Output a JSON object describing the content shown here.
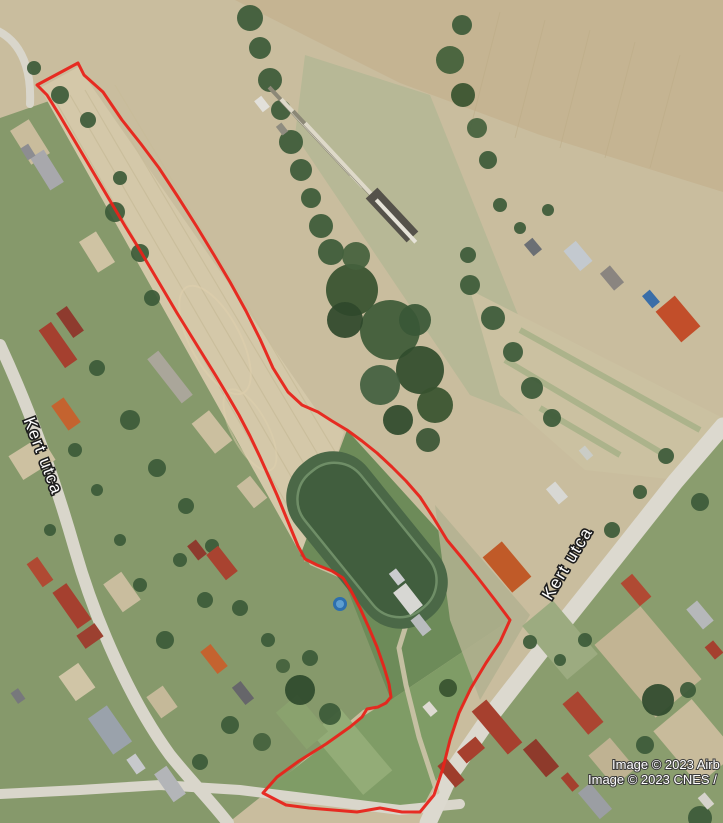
{
  "map": {
    "type": "satellite-imagery",
    "streets": [
      {
        "name": "Kert utca",
        "position": "west"
      },
      {
        "name": "Kert utca",
        "position": "east"
      }
    ],
    "attribution": [
      "Image © 2023 Airb",
      "Image © 2023 CNES /"
    ],
    "parcel": {
      "color": "#e8231a",
      "stroke_width": 3,
      "points": [
        [
          37,
          85
        ],
        [
          78,
          63
        ],
        [
          84,
          75
        ],
        [
          103,
          92
        ],
        [
          122,
          120
        ],
        [
          141,
          144
        ],
        [
          159,
          168
        ],
        [
          178,
          197
        ],
        [
          197,
          227
        ],
        [
          214,
          255
        ],
        [
          230,
          282
        ],
        [
          246,
          311
        ],
        [
          260,
          339
        ],
        [
          273,
          368
        ],
        [
          288,
          392
        ],
        [
          302,
          405
        ],
        [
          318,
          412
        ],
        [
          332,
          421
        ],
        [
          347,
          430
        ],
        [
          362,
          441
        ],
        [
          377,
          453
        ],
        [
          392,
          467
        ],
        [
          406,
          481
        ],
        [
          420,
          497
        ],
        [
          433,
          517
        ],
        [
          447,
          540
        ],
        [
          462,
          558
        ],
        [
          478,
          578
        ],
        [
          495,
          600
        ],
        [
          510,
          620
        ],
        [
          500,
          642
        ],
        [
          486,
          663
        ],
        [
          471,
          688
        ],
        [
          459,
          713
        ],
        [
          450,
          740
        ],
        [
          443,
          768
        ],
        [
          434,
          795
        ],
        [
          420,
          812
        ],
        [
          402,
          812
        ],
        [
          380,
          808
        ],
        [
          357,
          812
        ],
        [
          333,
          810
        ],
        [
          309,
          808
        ],
        [
          286,
          805
        ],
        [
          263,
          793
        ],
        [
          277,
          777
        ],
        [
          299,
          761
        ],
        [
          326,
          744
        ],
        [
          350,
          727
        ],
        [
          362,
          717
        ],
        [
          367,
          709
        ],
        [
          378,
          707
        ],
        [
          386,
          703
        ],
        [
          391,
          697
        ],
        [
          389,
          684
        ],
        [
          384,
          667
        ],
        [
          377,
          647
        ],
        [
          369,
          628
        ],
        [
          360,
          608
        ],
        [
          350,
          589
        ],
        [
          343,
          578
        ],
        [
          332,
          571
        ],
        [
          317,
          565
        ],
        [
          305,
          559
        ],
        [
          298,
          546
        ],
        [
          291,
          529
        ],
        [
          284,
          512
        ],
        [
          277,
          495
        ],
        [
          269,
          477
        ],
        [
          260,
          457
        ],
        [
          250,
          436
        ],
        [
          239,
          415
        ],
        [
          228,
          396
        ],
        [
          216,
          376
        ],
        [
          203,
          355
        ],
        [
          190,
          334
        ],
        [
          177,
          313
        ],
        [
          164,
          291
        ],
        [
          151,
          269
        ],
        [
          138,
          247
        ],
        [
          125,
          226
        ],
        [
          112,
          204
        ],
        [
          99,
          182
        ],
        [
          86,
          160
        ],
        [
          73,
          138
        ],
        [
          60,
          116
        ],
        [
          47,
          95
        ]
      ]
    },
    "palette": {
      "field_tan": "#c9bd9e",
      "field_light": "#d4c8a9",
      "field_harvest": "#c5b492",
      "meadow": "#b7b896",
      "village_green": "#86996b",
      "grass_dark": "#6d8b59",
      "pentagon_green": "#7f9c66",
      "village_east": "#8a9d6e",
      "tree_green": "#3c5a38",
      "road": "#d9d6cb",
      "sports_field": "#4b6847",
      "pool_blue": "#2d6fae",
      "label_fill": "#ffffff",
      "label_halo": "#1d1d1d"
    }
  }
}
